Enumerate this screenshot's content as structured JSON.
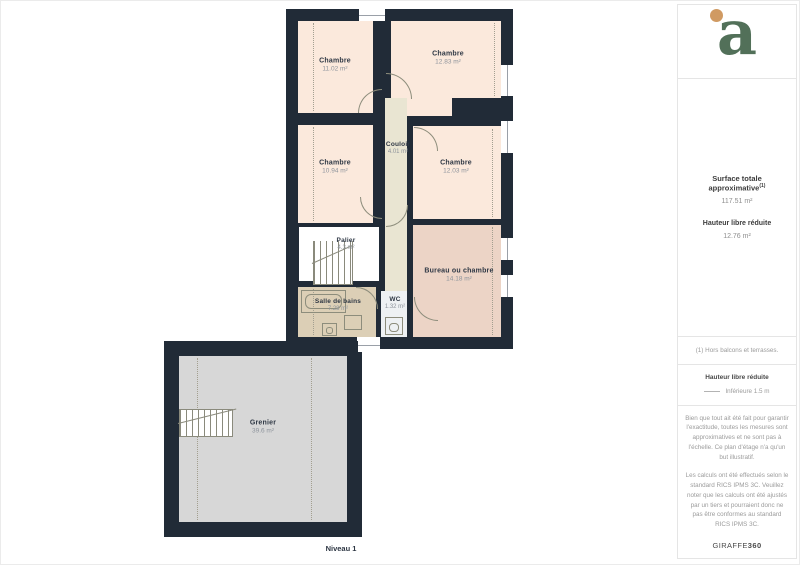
{
  "plan": {
    "level_label": "Niveau 1",
    "rooms": [
      {
        "name": "Chambre",
        "area": "11.02 m²"
      },
      {
        "name": "Chambre",
        "area": "12.83 m²"
      },
      {
        "name": "Chambre",
        "area": "10.94 m²"
      },
      {
        "name": "Chambre",
        "area": "12.03 m²"
      },
      {
        "name": "Couloir",
        "area": "4.01 m²"
      },
      {
        "name": "Palier",
        "area": "4.3 m²"
      },
      {
        "name": "Salle de bains",
        "area": "7.28 m²"
      },
      {
        "name": "WC",
        "area": "1.32 m²"
      },
      {
        "name": "Bureau ou chambre",
        "area": "14.18 m²"
      },
      {
        "name": "Grenier",
        "area": "39.6 m²"
      }
    ]
  },
  "sidebar": {
    "logo_letter": "a",
    "surface": {
      "heading": "Surface totale approximative",
      "heading_sup": "(1)",
      "value": "117.51 m²",
      "sub_heading": "Hauteur libre réduite",
      "sub_value": "12.76 m²"
    },
    "footnote": "(1) Hors balcons et terrasses.",
    "legend": {
      "title": "Hauteur libre réduite",
      "item": "Inférieure 1.5 m"
    },
    "disclaimer_1": "Bien que tout ait été fait pour garantir l'exactitude, toutes les mesures sont approximatives et ne sont pas à l'échelle. Ce plan d'étage n'a qu'un but illustratif.",
    "disclaimer_2": "Les calculs ont été effectués selon le standard RICS IPMS 3C. Veuillez noter que les calculs ont été ajustés par un tiers et pourraient donc ne pas être conformes au standard RICS IPMS 3C.",
    "brand": "GIRAFFE",
    "brand_suffix": "360"
  },
  "colors": {
    "wall": "#212b37",
    "room_peach": "#fbe9dc",
    "corridor_olive": "#e9e5d2",
    "bathroom_tan": "#dccfb6",
    "office_pink": "#ecd4c6",
    "wc_light": "#eef1f3",
    "attic_gray": "#d7d7d7",
    "logo_green": "#527059",
    "logo_orange": "#d09a62"
  }
}
